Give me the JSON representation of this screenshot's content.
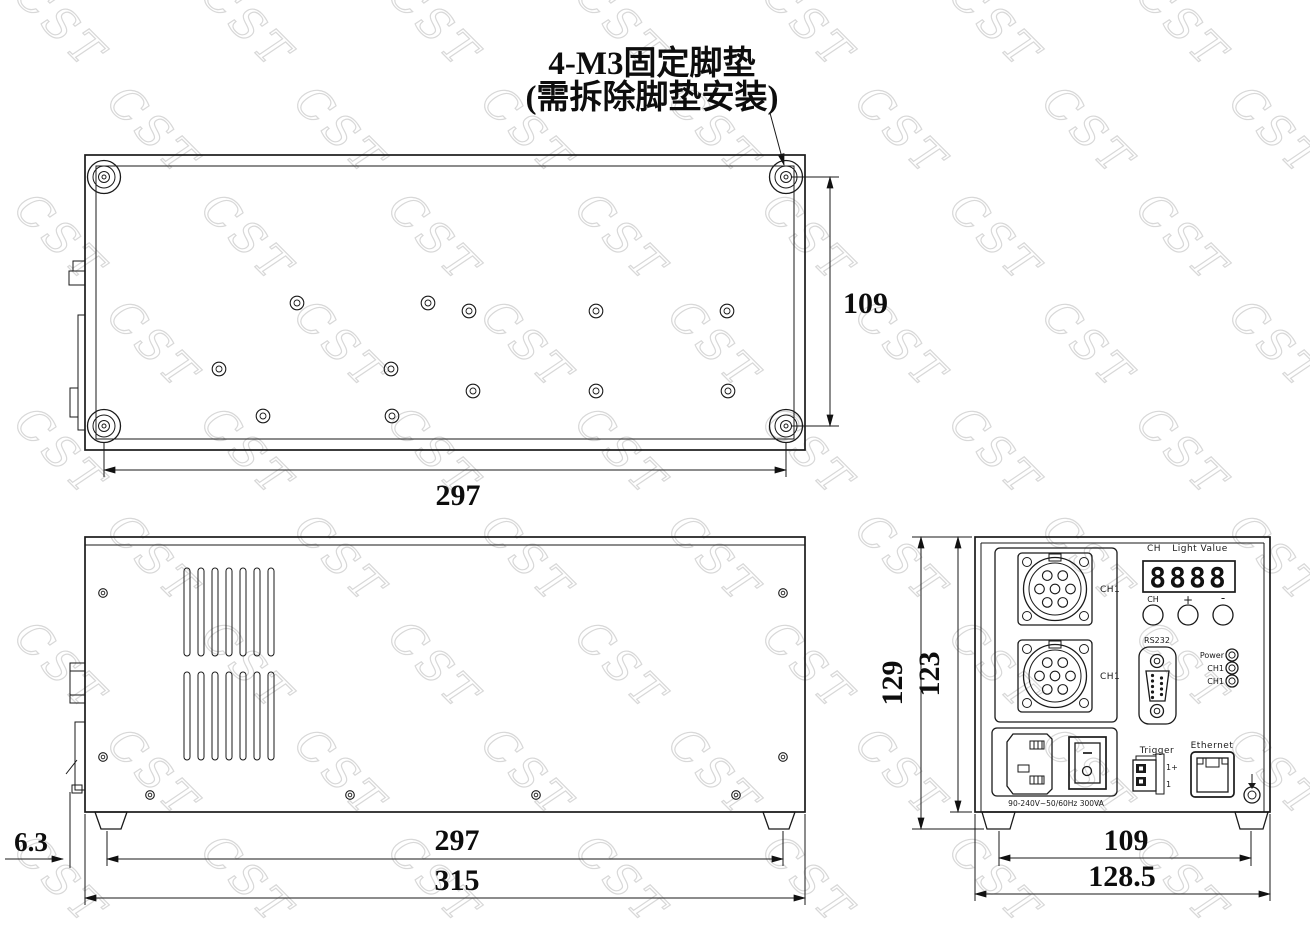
{
  "title": {
    "line1": "4-M3固定脚垫",
    "line2": "(需拆除脚垫安装)"
  },
  "watermark": {
    "text": "CST"
  },
  "colors": {
    "line": "#1a1a1a",
    "watermark": "#d8d8d8",
    "background": "#ffffff"
  },
  "dimensions": {
    "top_view": {
      "height": "109",
      "width": "297"
    },
    "side_view": {
      "protrusion": "6.3",
      "feet_span": "297",
      "width": "315"
    },
    "rear_view": {
      "overall_height": "129",
      "body_height": "123",
      "feet_span": "109",
      "width": "128.5"
    }
  },
  "rear_panel": {
    "display": {
      "ch_label": "CH",
      "value_label": "Light Value",
      "digits": "8888"
    },
    "buttons": [
      {
        "label": "CH"
      },
      {
        "label": "+"
      },
      {
        "label": "-"
      }
    ],
    "connectors": [
      {
        "label": "CH1"
      },
      {
        "label": "CH1"
      }
    ],
    "rs232_label": "RS232",
    "leds": [
      {
        "label": "Power"
      },
      {
        "label": "CH1"
      },
      {
        "label": "CH1"
      }
    ],
    "trigger": {
      "label": "Trigger",
      "pin_plus": "1+",
      "pin_minus": "1"
    },
    "ethernet_label": "Ethernet",
    "power_rating": "90-240V~50/60Hz 300VA"
  }
}
